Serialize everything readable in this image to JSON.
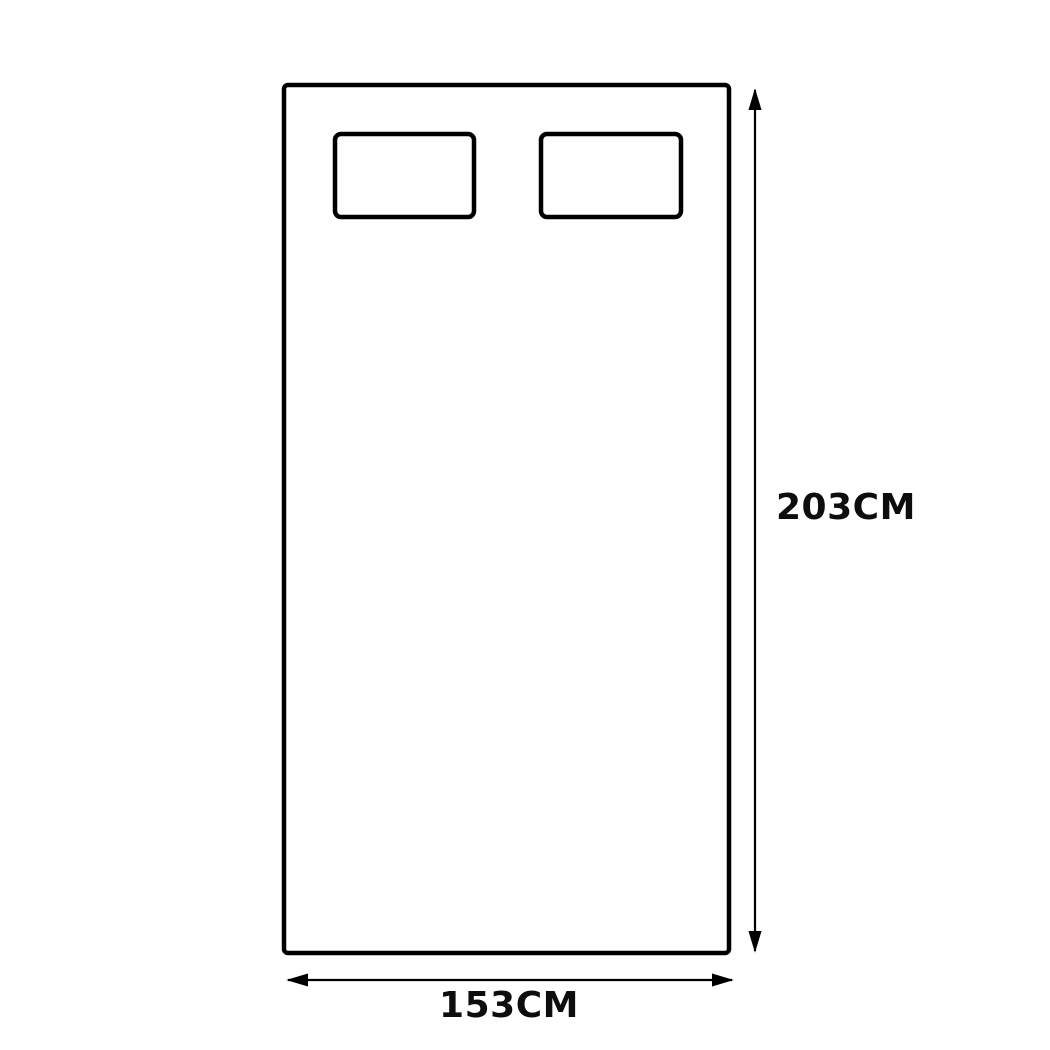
{
  "diagram": {
    "type": "product-dimension-drawing",
    "subject": "mattress-top-view-with-two-pillows",
    "height_dimension": {
      "label": "203CM"
    },
    "width_dimension": {
      "label": "153CM"
    },
    "colors": {
      "outline": "#000000",
      "dimension_line": "#000000",
      "label_text": "#0d0d0d",
      "background": "#ffffff"
    }
  }
}
